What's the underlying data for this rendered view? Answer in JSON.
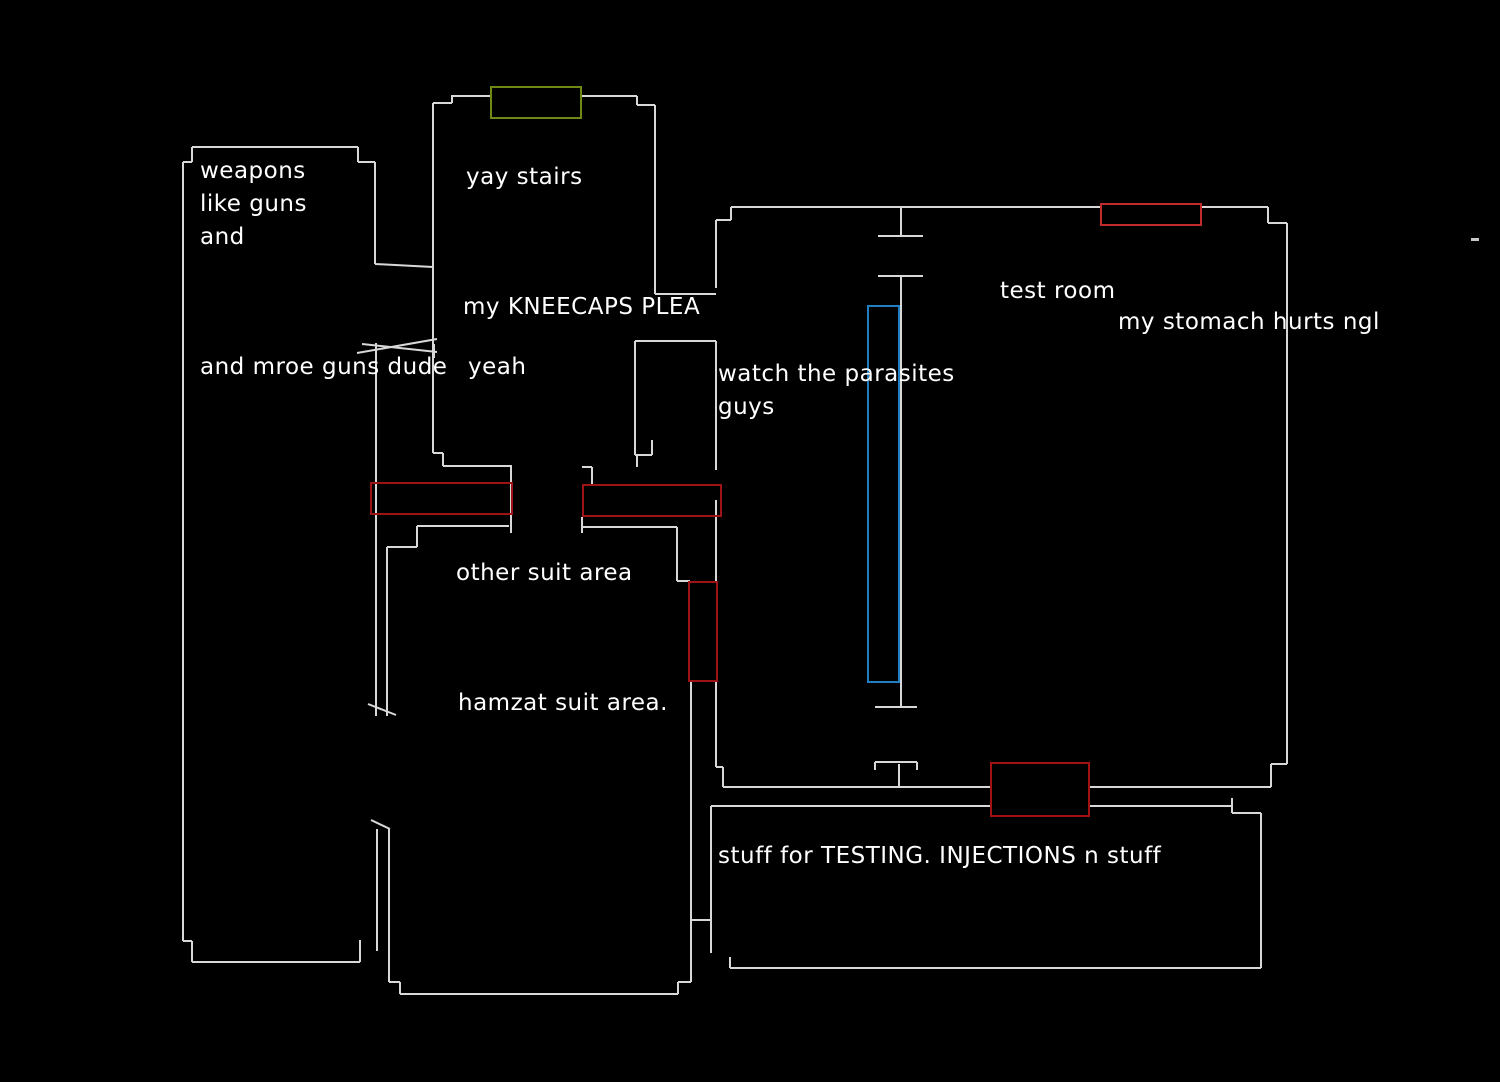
{
  "canvas": {
    "width": 1500,
    "height": 1082,
    "background": "#000000"
  },
  "colors": {
    "wall": "#d8d8d8",
    "text": "#ffffff",
    "stairs_marker": "#6f8914",
    "door_marker_top": "#c32b2b",
    "door_marker_side": "#9e1416",
    "door_marker_bottom": "#a31111",
    "glass_marker": "#1f7fc0"
  },
  "labels": [
    {
      "id": "weapons-line1",
      "text": "weapons",
      "x": 200,
      "y": 160
    },
    {
      "id": "weapons-line2",
      "text": "like guns",
      "x": 200,
      "y": 193
    },
    {
      "id": "weapons-line3",
      "text": "and",
      "x": 200,
      "y": 226
    },
    {
      "id": "yay-stairs",
      "text": "yay stairs",
      "x": 466,
      "y": 166
    },
    {
      "id": "kneecaps",
      "text": "my KNEECAPS PLEA",
      "x": 463,
      "y": 296
    },
    {
      "id": "more-guns",
      "text": "and mroe guns dude",
      "x": 200,
      "y": 356
    },
    {
      "id": "yeah",
      "text": "yeah",
      "x": 468,
      "y": 356
    },
    {
      "id": "parasites-1",
      "text": "watch the parasites",
      "x": 718,
      "y": 363
    },
    {
      "id": "parasites-2",
      "text": "guys",
      "x": 718,
      "y": 396
    },
    {
      "id": "test-room",
      "text": "test room",
      "x": 1000,
      "y": 280
    },
    {
      "id": "stomach",
      "text": "my stomach hurts ngl",
      "x": 1118,
      "y": 311
    },
    {
      "id": "other-suit",
      "text": "other suit area",
      "x": 456,
      "y": 562
    },
    {
      "id": "hamzat-suit",
      "text": "hamzat suit area.",
      "x": 458,
      "y": 692
    },
    {
      "id": "testing-stuff",
      "text": "stuff for TESTING. INJECTIONS n stuff",
      "x": 718,
      "y": 845
    }
  ],
  "markers": [
    {
      "id": "stairs-marker",
      "x": 490,
      "y": 86,
      "w": 92,
      "h": 33,
      "color": "#6f8914"
    },
    {
      "id": "door-marker-top",
      "x": 1100,
      "y": 203,
      "w": 102,
      "h": 23,
      "color": "#c32b2b"
    },
    {
      "id": "door-marker-left",
      "x": 370,
      "y": 482,
      "w": 143,
      "h": 33,
      "color": "#9e1416"
    },
    {
      "id": "door-marker-right",
      "x": 582,
      "y": 484,
      "w": 140,
      "h": 33,
      "color": "#9e1416"
    },
    {
      "id": "door-marker-middle",
      "x": 688,
      "y": 581,
      "w": 30,
      "h": 101,
      "color": "#9e1416"
    },
    {
      "id": "door-marker-bottom",
      "x": 990,
      "y": 762,
      "w": 100,
      "h": 55,
      "color": "#a31111"
    },
    {
      "id": "glass-marker",
      "x": 867,
      "y": 305,
      "w": 33,
      "h": 378,
      "color": "#1f7fc0"
    }
  ],
  "artifact_dash": {
    "x": 1471,
    "y": 238,
    "w": 8,
    "h": 3
  }
}
